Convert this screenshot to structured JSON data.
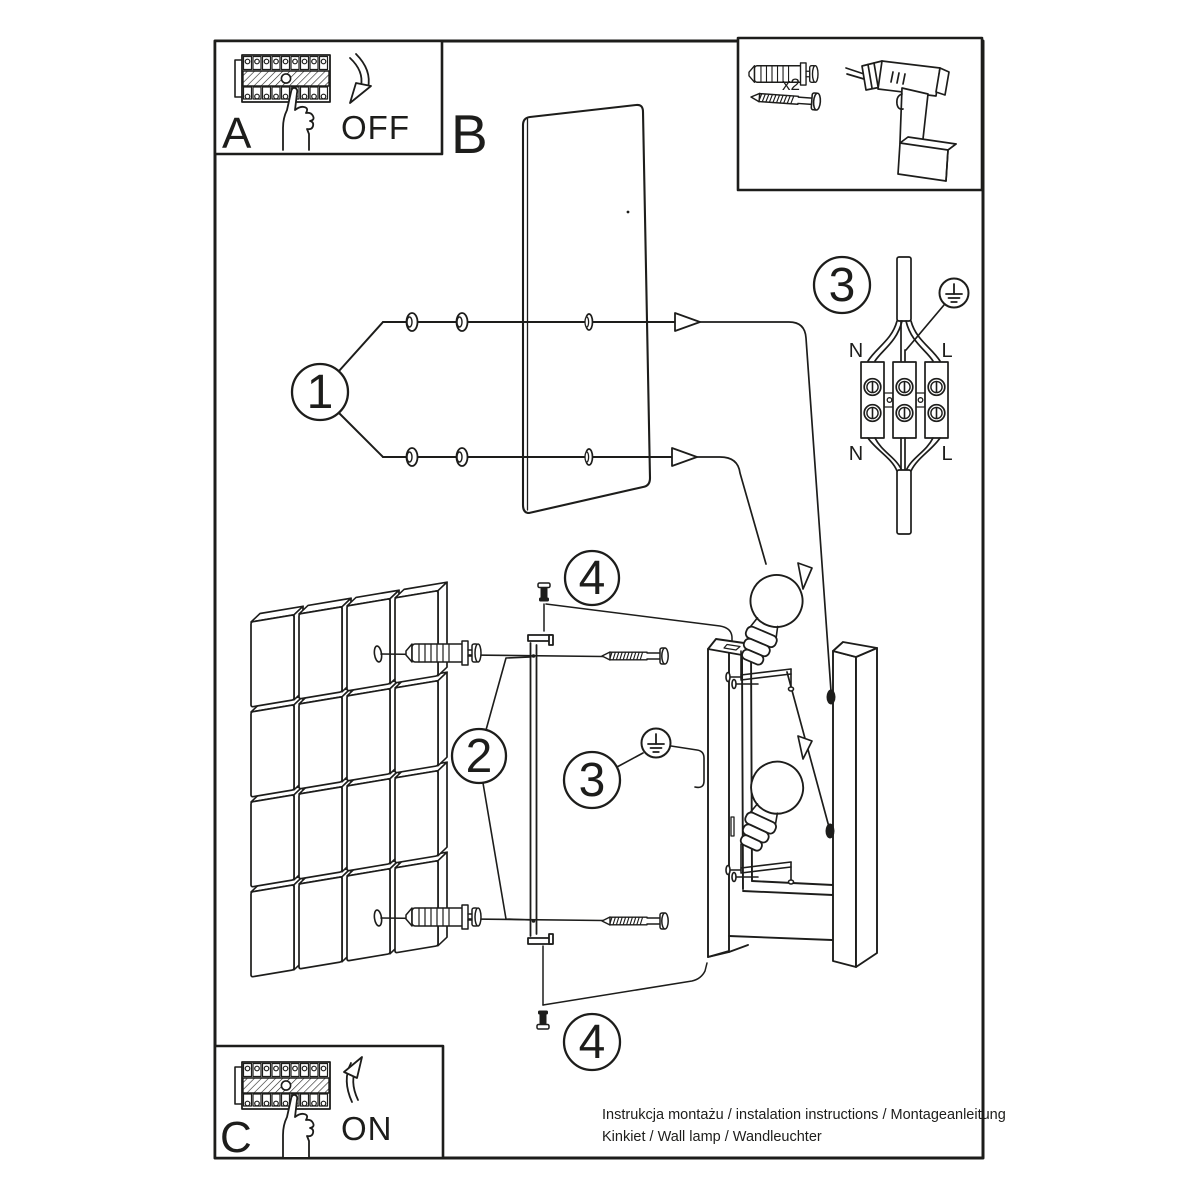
{
  "labels": {
    "panel_off": "A",
    "plate": "B",
    "panel_on": "C"
  },
  "actions": {
    "off": "OFF",
    "on": "ON"
  },
  "hardware": {
    "anchor_qty": "x2"
  },
  "steps": {
    "s1": "1",
    "s2": "2",
    "s3": "3",
    "s4": "4"
  },
  "wiring": {
    "n_top": "N",
    "l_top": "L",
    "n_bottom": "N",
    "l_bottom": "L"
  },
  "footer": {
    "line1": "Instrukcja montażu / instalation instructions / Montageanleitung",
    "line2": "Kinkiet / Wall lamp / Wandleuchter"
  },
  "colors": {
    "ink": "#1d1d1b",
    "paper": "#ffffff"
  }
}
